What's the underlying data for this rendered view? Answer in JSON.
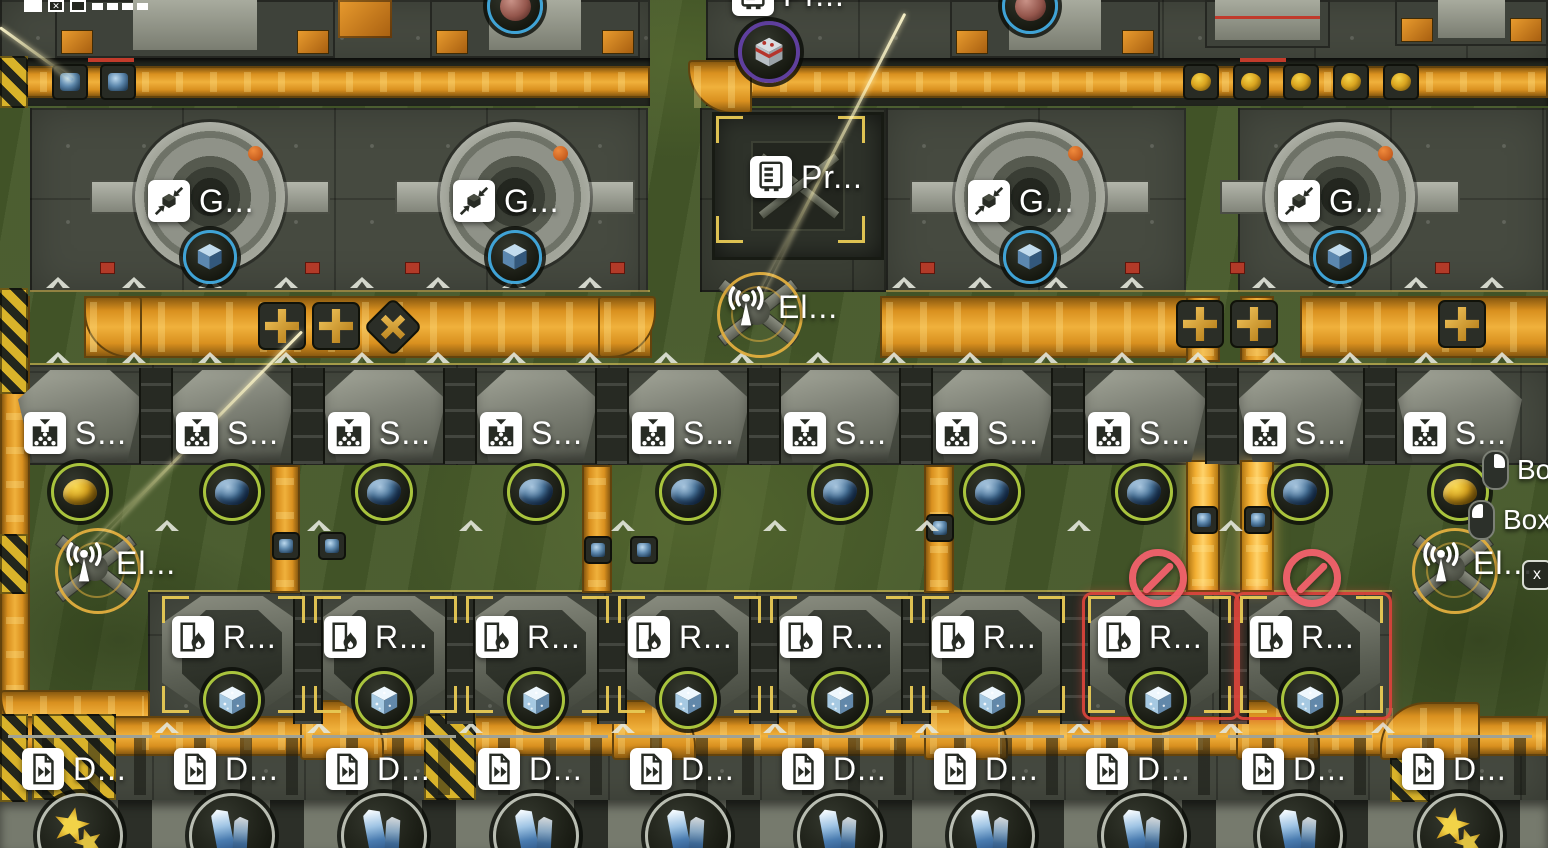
{
  "scene": {
    "labels": {
      "grinder": "G...",
      "processor": "Pr...",
      "processor_top": "Pr...",
      "antenna": "El...",
      "sorter": "S...",
      "refinery": "R...",
      "depot": "D..."
    },
    "machine_rows": {
      "grinders": {
        "count": 4,
        "item": "blue-cube"
      },
      "sorters": {
        "count": 10,
        "items": [
          "yellow-ore",
          "blue-ore",
          "blue-ore",
          "blue-ore",
          "blue-ore",
          "blue-ore",
          "blue-ore",
          "blue-ore",
          "blue-ore",
          "yellow-ore"
        ]
      },
      "refineries": {
        "count": 8,
        "item": "ice-cube",
        "disabled_indices": [
          6,
          7
        ]
      },
      "depots": {
        "count": 10,
        "items": [
          "yellow-flowers",
          "blue-crystal",
          "blue-crystal",
          "blue-crystal",
          "blue-crystal",
          "blue-crystal",
          "blue-crystal",
          "blue-crystal",
          "blue-crystal",
          "yellow-flowers"
        ]
      }
    },
    "top_items": [
      "maroon-sphere",
      "red-crate",
      "maroon-sphere"
    ],
    "belt_cargo": {
      "top_ore_boxes": 5,
      "blue_boxes": 9
    }
  },
  "hud": {
    "hints": [
      {
        "icon": "mouse-right-icon",
        "label": "Bo..."
      },
      {
        "icon": "mouse-left-icon",
        "label": "Box S..."
      }
    ],
    "key_hint": "x"
  },
  "colors": {
    "belt_orange": "#d9901f",
    "belt_highlight": "#f0b13c",
    "floor_gray": "#464a40",
    "grass_green": "#46592a",
    "accent_yellow": "#e8ca55",
    "disabled_red": "#f2616c",
    "ring_cyan": "#3fa3d6",
    "ring_olive": "#a9c43d",
    "ring_purple": "#5f3f9e",
    "ring_gray": "#b9bdb2",
    "label_white": "#ffffff"
  }
}
